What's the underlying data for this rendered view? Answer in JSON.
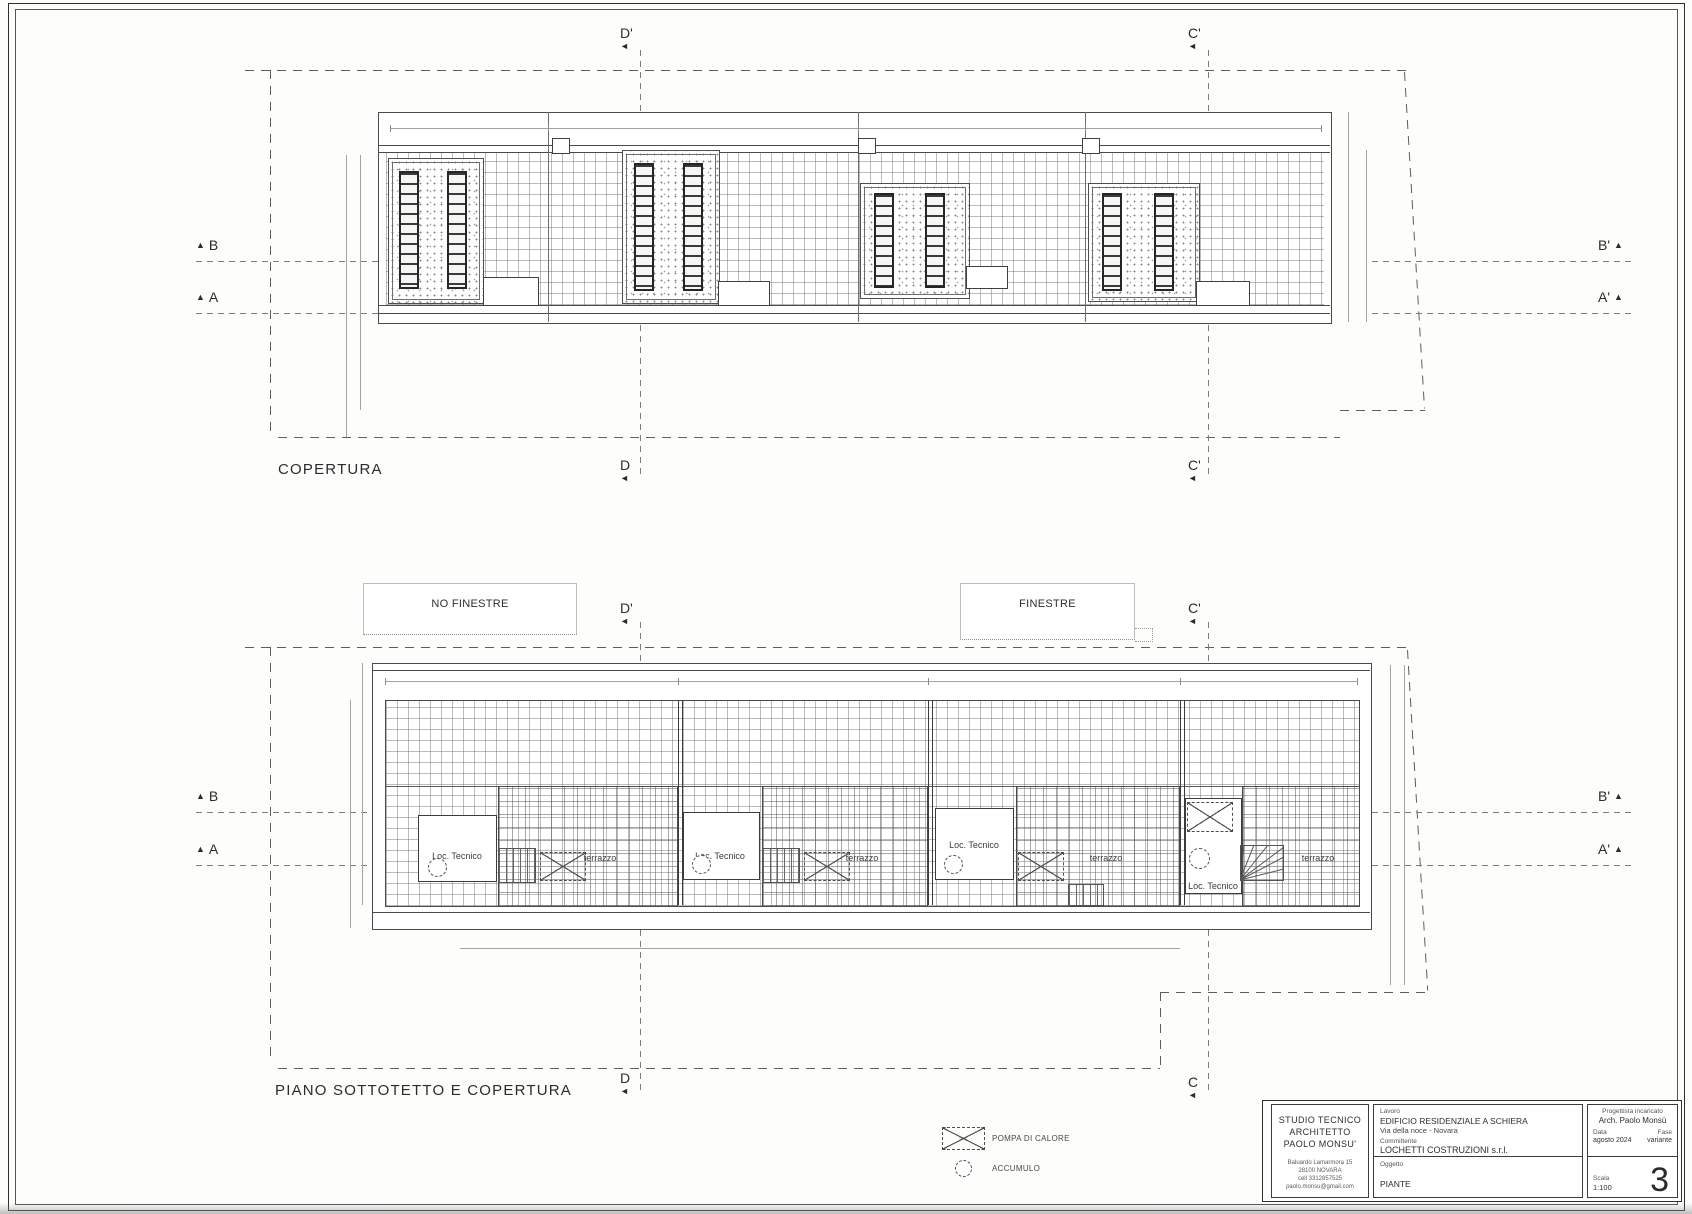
{
  "icons": {
    "arrow_left": "◄",
    "arrow_up": "▲"
  },
  "plan_top": {
    "title": "COPERTURA",
    "sections": {
      "d_top": "D'",
      "c_top": "C'",
      "d_bottom": "D",
      "c_bottom": "C'",
      "b_left": "B",
      "a_left": "A",
      "b_right": "B'",
      "a_right": "A'"
    }
  },
  "plan_bottom": {
    "title": "PIANO SOTTOTETTO E COPERTURA",
    "sections": {
      "d_top": "D'",
      "c_top": "C'",
      "d_bottom": "D",
      "c_bottom": "C",
      "b_left": "B",
      "a_left": "A",
      "b_right": "B'",
      "a_right": "A'"
    },
    "units": [
      {
        "room": "Loc. Tecnico",
        "terrace": "terrazzo"
      },
      {
        "room": "Loc. Tecnico",
        "terrace": "terrazzo"
      },
      {
        "room": "Loc. Tecnico",
        "terrace": "terrazzo"
      },
      {
        "room": "Loc. Tecnico",
        "terrace": "terrazzo"
      }
    ]
  },
  "notes": {
    "no_windows": "NO FINESTRE",
    "windows": "FINESTRE"
  },
  "legend": {
    "heat_pump": "POMPA DI CALORE",
    "accumulator": "ACCUMULO"
  },
  "title_block": {
    "studio": {
      "line1": "STUDIO TECNICO",
      "line2": "ARCHITETTO",
      "line3": "PAOLO  MONSU'",
      "address1": "Baluardo Lamarmora  15",
      "address2": "28100      NOVARA",
      "address3": "cell  3312857525",
      "address4": "paolo.monsu@gmail.com"
    },
    "lavoro_label": "Lavoro",
    "lavoro_line1": "EDIFICIO RESIDENZIALE A SCHIERA",
    "lavoro_line2": "Via della noce - Novara",
    "committente_label": "Committente",
    "committente": "LOCHETTI COSTRUZIONI s.r.l.",
    "oggetto_label": "Oggetto",
    "oggetto": "PIANTE",
    "progettista_label": "Progettista incaricato",
    "progettista": "Arch. Paolo Monsù",
    "data_label": "Data",
    "data": "agosto 2024",
    "fase_label": "Fase",
    "fase": "variante",
    "scala_label": "Scala",
    "scala": "1:100",
    "sheet_number": "3"
  }
}
